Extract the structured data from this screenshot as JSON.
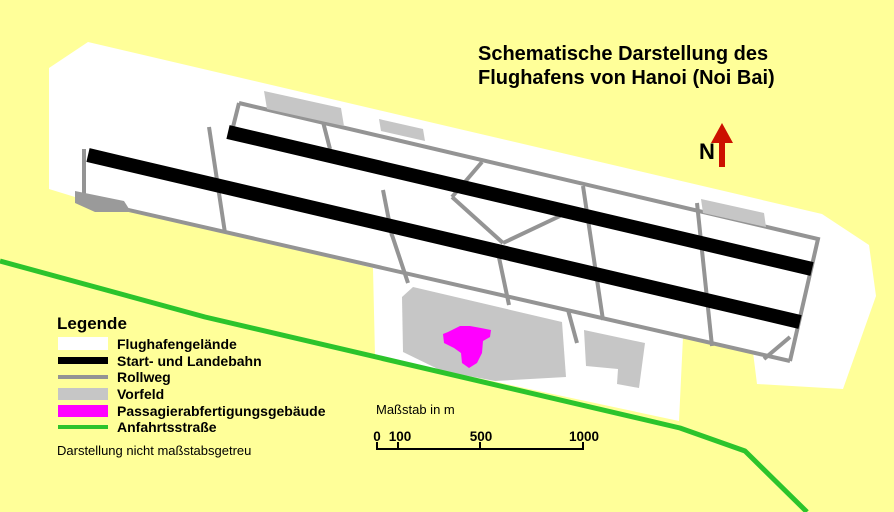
{
  "title": {
    "line1": "Schematische Darstellung des",
    "line2": "Flughafens von Hanoi (Noi Bai)"
  },
  "north": {
    "label": "N"
  },
  "legend": {
    "title": "Legende",
    "items": [
      {
        "label": "Flughafengelände",
        "swatch": "white-area"
      },
      {
        "label": "Start- und Landebahn",
        "swatch": "black-thick-line"
      },
      {
        "label": "Rollweg",
        "swatch": "gray-line"
      },
      {
        "label": "Vorfeld",
        "swatch": "light-gray-area"
      },
      {
        "label": "Passagierabfertigungsgebäude",
        "swatch": "magenta-area"
      },
      {
        "label": "Anfahrtsstraße",
        "swatch": "green-line"
      }
    ],
    "note": "Darstellung nicht maßstabsgetreu"
  },
  "scalebar": {
    "label": "Maßstab in m",
    "ticks": [
      "0",
      "100",
      "500",
      "1000"
    ]
  },
  "colors": {
    "background": "#ffff99",
    "airport_area": "#ffffff",
    "runway": "#000000",
    "taxiway": "#949494",
    "apron": "#c6c6c6",
    "apron_dark": "#9a9a9a",
    "terminal": "#ff00ff",
    "road": "#2cc42c",
    "north_arrow": "#cc1100",
    "text": "#000000"
  }
}
